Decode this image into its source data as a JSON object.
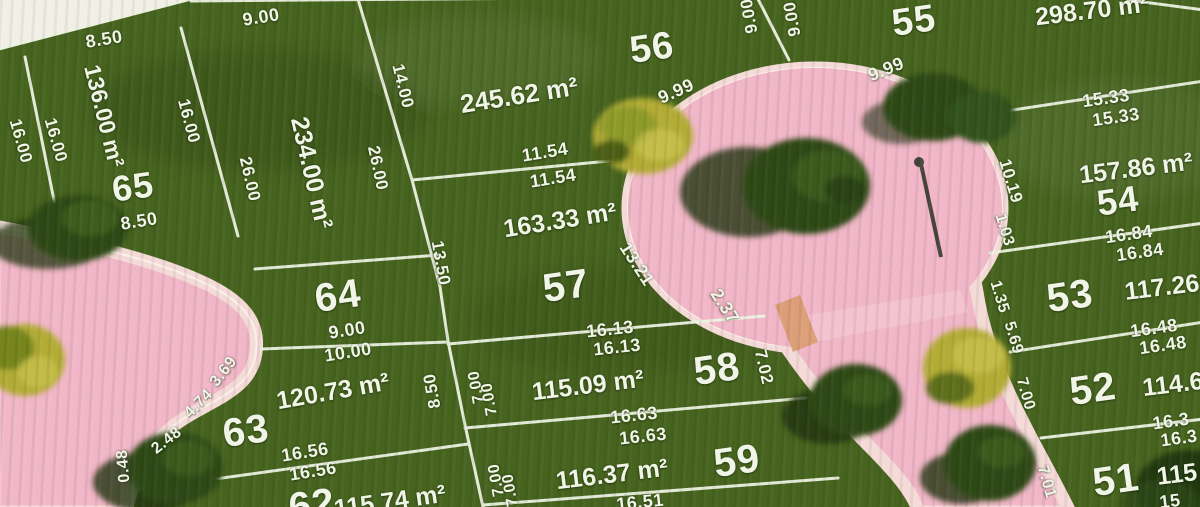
{
  "map_type": "residential-subdivision-plan",
  "colors": {
    "grass": "#47641f",
    "road": "#f1b7c8",
    "roadRim": "#f5dbd8",
    "line": "#edf2e2",
    "label": "#f1f5e8",
    "treeDark": "#2e4a15",
    "treeShadow": "#20340e",
    "treeYellow": "#b2ac35",
    "paper": "#f2efe6",
    "lamp": "#45453c",
    "tan": "#d89a6a"
  },
  "lots": [
    {
      "number": "51",
      "area": "115"
    },
    {
      "number": "52",
      "area": "114.6"
    },
    {
      "number": "53",
      "area": "117.26"
    },
    {
      "number": "54",
      "area": "157.86 m²"
    },
    {
      "number": "55",
      "area": "298.70 m²"
    },
    {
      "number": "56",
      "area": "245.62 m²"
    },
    {
      "number": "57",
      "area": "163.33 m²"
    },
    {
      "number": "58",
      "area": "115.09 m²"
    },
    {
      "number": "59",
      "area": "116.37 m²"
    },
    {
      "number": "62",
      "area": "115.74 m²"
    },
    {
      "number": "63",
      "area": "120.73 m²"
    },
    {
      "number": "64",
      "area": ""
    },
    {
      "number": "65",
      "area": "136.00 m²"
    },
    {
      "number": "",
      "area": "234.00 m²"
    }
  ],
  "labels": {
    "lot_numbers": [
      {
        "t": "65",
        "x": 133,
        "y": 187,
        "r": -8,
        "s": 36
      },
      {
        "t": "64",
        "x": 338,
        "y": 296,
        "r": -8
      },
      {
        "t": "63",
        "x": 246,
        "y": 431,
        "r": -8
      },
      {
        "t": "62",
        "x": 312,
        "y": 505,
        "r": -8
      },
      {
        "t": "56",
        "x": 652,
        "y": 48,
        "r": -8,
        "s": 38
      },
      {
        "t": "57",
        "x": 566,
        "y": 286,
        "r": -8
      },
      {
        "t": "58",
        "x": 717,
        "y": 369,
        "r": -8
      },
      {
        "t": "59",
        "x": 737,
        "y": 461,
        "r": -8
      },
      {
        "t": "55",
        "x": 914,
        "y": 21,
        "r": -8,
        "s": 38
      },
      {
        "t": "54",
        "x": 1118,
        "y": 201,
        "r": -8,
        "s": 36
      },
      {
        "t": "53",
        "x": 1070,
        "y": 296,
        "r": -8
      },
      {
        "t": "52",
        "x": 1093,
        "y": 389,
        "r": -8
      },
      {
        "t": "51",
        "x": 1116,
        "y": 480,
        "r": -8
      }
    ],
    "areas": [
      {
        "t": "136.00 m²",
        "x": 104,
        "y": 116,
        "r": 76,
        "s": 23
      },
      {
        "t": "234.00 m²",
        "x": 311,
        "y": 173,
        "r": 77
      },
      {
        "t": "245.62 m²",
        "x": 519,
        "y": 95,
        "r": -9,
        "s": 26
      },
      {
        "t": "163.33 m²",
        "x": 560,
        "y": 221,
        "r": -9
      },
      {
        "t": "115.09 m²",
        "x": 588,
        "y": 386,
        "r": -7
      },
      {
        "t": "116.37 m²",
        "x": 612,
        "y": 475,
        "r": -7
      },
      {
        "t": "120.73 m²",
        "x": 333,
        "y": 392,
        "r": -10
      },
      {
        "t": "115.74 m²",
        "x": 390,
        "y": 502,
        "r": -8
      },
      {
        "t": "298.70 m²",
        "x": 1092,
        "y": 11,
        "r": -7
      },
      {
        "t": "157.86 m²",
        "x": 1136,
        "y": 169,
        "r": -7
      },
      {
        "t": "117.26",
        "x": 1162,
        "y": 288,
        "r": -7
      },
      {
        "t": "114.6",
        "x": 1173,
        "y": 385,
        "r": -7
      },
      {
        "t": "115",
        "x": 1177,
        "y": 475,
        "r": -7
      }
    ],
    "dimensions": [
      {
        "t": "8.50",
        "x": 104,
        "y": 39,
        "r": -9
      },
      {
        "t": "9.00",
        "x": 261,
        "y": 17,
        "r": -9
      },
      {
        "t": "16.00",
        "x": 21,
        "y": 141,
        "r": 74,
        "s": 17
      },
      {
        "t": "16.00",
        "x": 56,
        "y": 140,
        "r": 74,
        "s": 17
      },
      {
        "t": "16.00",
        "x": 189,
        "y": 121,
        "r": 75,
        "s": 17
      },
      {
        "t": "26.00",
        "x": 250,
        "y": 179,
        "r": 77,
        "s": 17
      },
      {
        "t": "8.50",
        "x": 139,
        "y": 221,
        "r": -9
      },
      {
        "t": "14.00",
        "x": 403,
        "y": 86,
        "r": 76,
        "s": 17
      },
      {
        "t": "26.00",
        "x": 378,
        "y": 168,
        "r": 78,
        "s": 17
      },
      {
        "t": "13.50",
        "x": 441,
        "y": 263,
        "r": 80,
        "s": 17
      },
      {
        "t": "11.54",
        "x": 545,
        "y": 152,
        "r": -9
      },
      {
        "t": "11.54",
        "x": 553,
        "y": 178,
        "r": -9
      },
      {
        "t": "9.99",
        "x": 676,
        "y": 91,
        "r": -24
      },
      {
        "t": "9.00",
        "x": 749,
        "y": 16,
        "r": -100,
        "s": 17
      },
      {
        "t": "9.00",
        "x": 792,
        "y": 19,
        "r": -100,
        "s": 17
      },
      {
        "t": "9.99",
        "x": 886,
        "y": 69,
        "r": -22
      },
      {
        "t": "15.33",
        "x": 1106,
        "y": 98,
        "r": -8
      },
      {
        "t": "15.33",
        "x": 1116,
        "y": 117,
        "r": -8
      },
      {
        "t": "10.19",
        "x": 1011,
        "y": 181,
        "r": 73,
        "s": 17
      },
      {
        "t": "16.84",
        "x": 1129,
        "y": 234,
        "r": -8
      },
      {
        "t": "16.84",
        "x": 1140,
        "y": 252,
        "r": -8
      },
      {
        "t": "1.03",
        "x": 1004,
        "y": 230,
        "r": 73,
        "s": 16
      },
      {
        "t": "1.35",
        "x": 999,
        "y": 297,
        "r": 73,
        "s": 16
      },
      {
        "t": "5.69",
        "x": 1013,
        "y": 338,
        "r": 73,
        "s": 16
      },
      {
        "t": "16.48",
        "x": 1154,
        "y": 328,
        "r": -8
      },
      {
        "t": "16.48",
        "x": 1163,
        "y": 345,
        "r": -8
      },
      {
        "t": "7.00",
        "x": 1025,
        "y": 394,
        "r": 74,
        "s": 16
      },
      {
        "t": "16.3",
        "x": 1171,
        "y": 421,
        "r": -8
      },
      {
        "t": "16.3",
        "x": 1179,
        "y": 438,
        "r": -8
      },
      {
        "t": "7.01",
        "x": 1046,
        "y": 482,
        "r": 74,
        "s": 16
      },
      {
        "t": "15",
        "x": 1170,
        "y": 501,
        "r": -7
      },
      {
        "t": "13.21",
        "x": 637,
        "y": 264,
        "r": 57
      },
      {
        "t": "2.37",
        "x": 725,
        "y": 306,
        "r": 57
      },
      {
        "t": "16.13",
        "x": 610,
        "y": 329,
        "r": -6
      },
      {
        "t": "16.13",
        "x": 617,
        "y": 347,
        "r": -6
      },
      {
        "t": "7.02",
        "x": 764,
        "y": 367,
        "r": 77,
        "s": 17
      },
      {
        "t": "16.63",
        "x": 634,
        "y": 415,
        "r": -6
      },
      {
        "t": "16.63",
        "x": 643,
        "y": 436,
        "r": -6
      },
      {
        "t": "8.50",
        "x": 432,
        "y": 391,
        "r": -100,
        "s": 17
      },
      {
        "t": "7.00",
        "x": 477,
        "y": 387,
        "r": -100,
        "s": 16
      },
      {
        "t": "7.00",
        "x": 490,
        "y": 399,
        "r": -100,
        "s": 16
      },
      {
        "t": "7.00",
        "x": 497,
        "y": 480,
        "r": -100,
        "s": 16
      },
      {
        "t": "7.00",
        "x": 511,
        "y": 490,
        "r": -100,
        "s": 16
      },
      {
        "t": "16.51",
        "x": 640,
        "y": 502,
        "r": -6
      },
      {
        "t": "9.00",
        "x": 347,
        "y": 330,
        "r": -9
      },
      {
        "t": "10.00",
        "x": 348,
        "y": 352,
        "r": -9
      },
      {
        "t": "16.56",
        "x": 305,
        "y": 452,
        "r": -9
      },
      {
        "t": "16.56",
        "x": 313,
        "y": 471,
        "r": -9
      },
      {
        "t": "2.48",
        "x": 167,
        "y": 441,
        "r": -38,
        "s": 16
      },
      {
        "t": "4.74",
        "x": 199,
        "y": 404,
        "r": -45,
        "s": 16
      },
      {
        "t": "3.69",
        "x": 224,
        "y": 372,
        "r": -52,
        "s": 16
      },
      {
        "t": "0.48",
        "x": 124,
        "y": 466,
        "r": -95,
        "s": 16
      }
    ]
  }
}
